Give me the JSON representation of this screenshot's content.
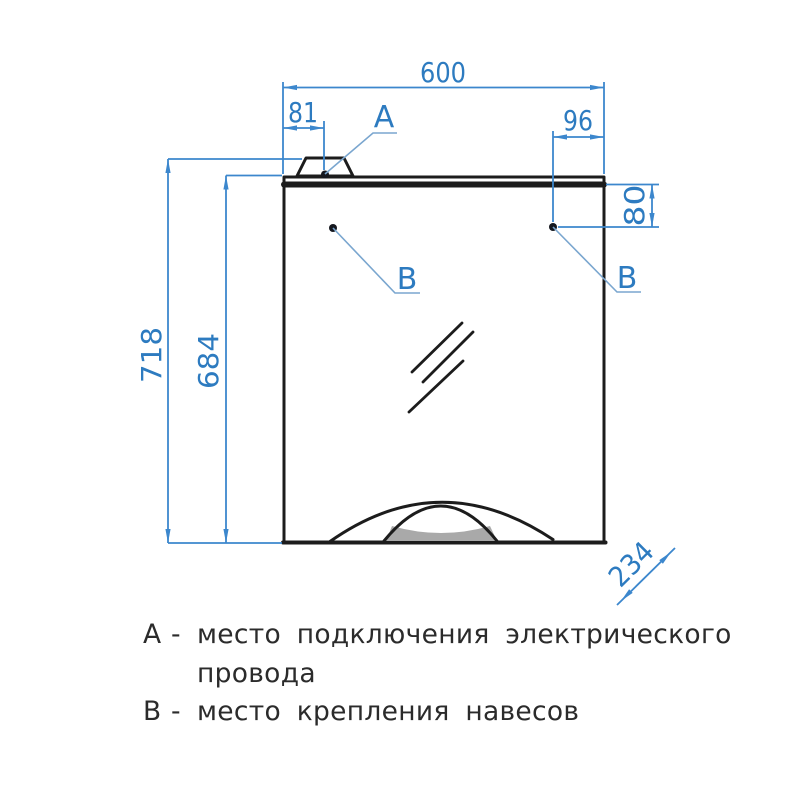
{
  "page": {
    "background": "#ffffff",
    "description": "Dimensioned front-elevation drawing of a mirror cabinet"
  },
  "drawing": {
    "dimensions": {
      "overall_width_mm": "600",
      "power_point_offset_mm": "81",
      "hinge_right_offset_x_mm": "96",
      "hinge_offset_y_mm": "80",
      "overall_height_mm": "718",
      "body_height_mm": "684",
      "depth_mm": "234"
    },
    "markers": {
      "power_label": "А",
      "hinge_left_label": "В",
      "hinge_right_label": "В"
    },
    "colors": {
      "dimension_blue": "#2d7bc0",
      "leader_blue": "#7aa6cf",
      "outline_black": "#1c1c1c",
      "shelf_gray": "#a9a9a9"
    }
  },
  "legend": {
    "items": [
      {
        "key": "А",
        "separator": "-",
        "line1": "место подключения электрического",
        "line2": "провода"
      },
      {
        "key": "В",
        "separator": "-",
        "line1": "место крепления навесов"
      }
    ]
  }
}
